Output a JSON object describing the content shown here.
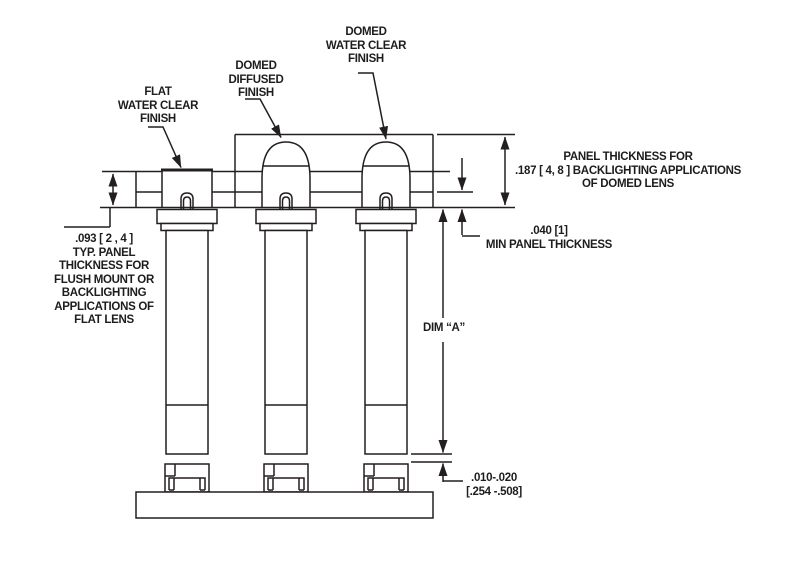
{
  "labels": {
    "domed_water_clear": [
      "DOMED",
      "WATER CLEAR",
      "FINISH"
    ],
    "domed_diffused": [
      "DOMED",
      "DIFFUSED",
      "FINISH"
    ],
    "flat_water_clear": [
      "FLAT",
      "WATER CLEAR",
      "FINISH"
    ]
  },
  "dimensions": {
    "domed_panel_thickness": [
      "PANEL THICKNESS FOR",
      ".187 [ 4, 8 ] BACKLIGHTING APPLICATIONS",
      "OF DOMED LENS"
    ],
    "min_panel_thickness": [
      ".040 [1]",
      "MIN PANEL THICKNESS"
    ],
    "flat_panel_thickness": [
      ".093 [ 2 , 4 ]",
      "TYP. PANEL",
      "THICKNESS FOR",
      "FLUSH MOUNT OR",
      "BACKLIGHTING",
      "APPLICATIONS OF",
      "FLAT LENS"
    ],
    "dim_a": "DIM “A”",
    "board_gap": [
      ".010-.020",
      "[.254 -.508]"
    ]
  },
  "colors": {
    "line": "#231f20",
    "text": "#1d1d1f",
    "background": "#ffffff"
  }
}
